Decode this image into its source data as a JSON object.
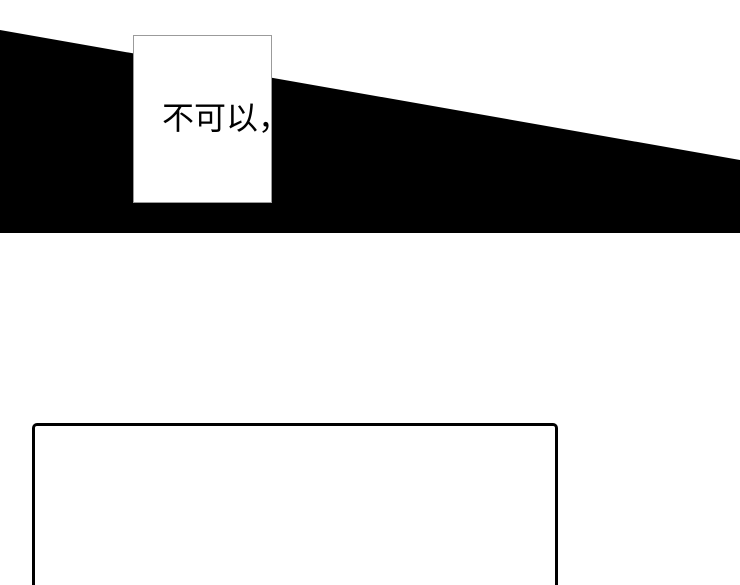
{
  "page": {
    "kind": "comic-panel-page",
    "background_color": "#ffffff"
  },
  "top_panel": {
    "shape": "black-wedge",
    "fill_color": "#000000"
  },
  "speech_bubble": {
    "text": "不可以，",
    "text_color": "#000000",
    "fill_color": "#ffffff",
    "border_color": "#9b9b9b"
  },
  "bottom_panel": {
    "fill_color": "#ffffff",
    "border_color": "#000000"
  }
}
